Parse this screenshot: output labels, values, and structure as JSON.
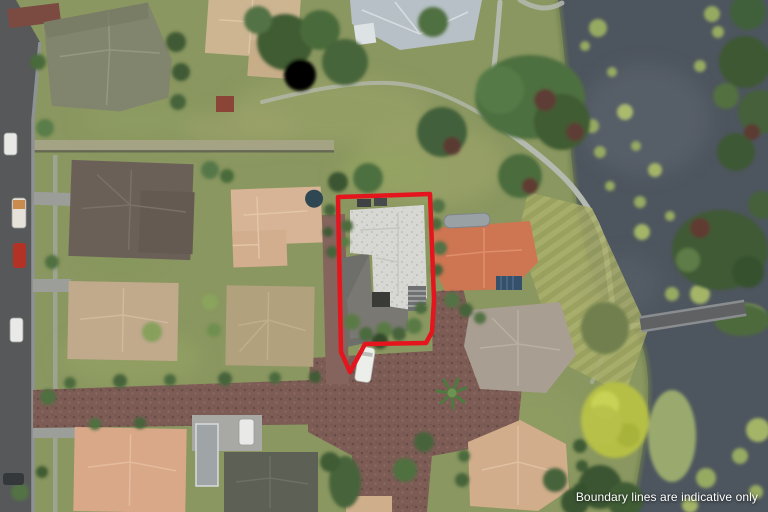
{
  "watermark": {
    "disclaimer": "Boundary lines are indicative only",
    "text_color": "#ffffff"
  },
  "boundary": {
    "color": "#e4151d"
  },
  "palette": {
    "water": "#4d555e",
    "road_asphalt": "#56585a",
    "paved_lane": "#7c5c55",
    "footpath": "#b5bab0",
    "grass": "#8a9760",
    "subject_roof": "#d7d7d3",
    "terracotta_roof": "#ce7552",
    "lily_pad": "#97aa62"
  }
}
